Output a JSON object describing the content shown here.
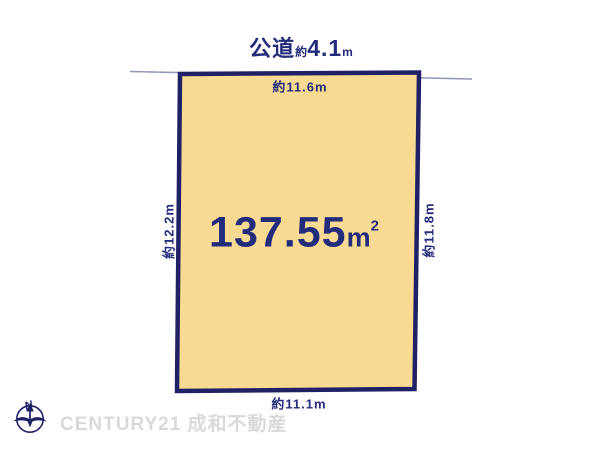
{
  "title": {
    "road_label": "公道",
    "approx_prefix": "約",
    "road_width_value": "4.1",
    "road_width_unit": "m"
  },
  "plot": {
    "area": {
      "value": "137.55",
      "unit": "m",
      "superscript": "2"
    },
    "dimensions": {
      "top": "約11.6m",
      "bottom": "約11.1m",
      "left": "約12.2m",
      "right": "約11.8m"
    }
  },
  "watermark": {
    "compass_label": "N",
    "brand": "CENTURY21 成和不動産"
  },
  "colors": {
    "navy_text": "#232c7a",
    "plot_border": "#1e2166",
    "plot_fill": "#f8da92",
    "road_line": "#9097b8",
    "watermark_gray": "#d9d9d9"
  }
}
